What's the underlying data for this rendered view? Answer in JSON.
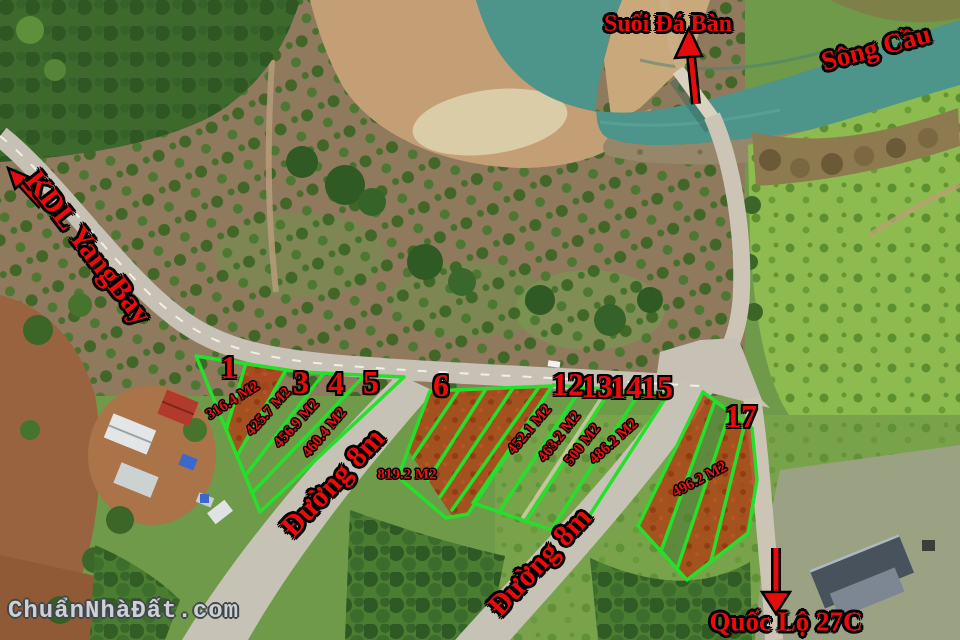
{
  "labels": {
    "stream": "Suối Đá Bàn",
    "river": "Sông Cầu",
    "kdl": "KDL YangBay",
    "road_a": "Đường 8m",
    "road_b": "Đường 8m",
    "highway": "Quốc Lộ 27C"
  },
  "watermark": "ChuẩnNhàĐất.com",
  "plots": [
    {
      "number": "1",
      "area": "316.4 M2"
    },
    {
      "number": "3",
      "area": "425.7 M2"
    },
    {
      "number": "4",
      "area": "456.9 M2"
    },
    {
      "number": "5",
      "area": "460.4 M2"
    },
    {
      "number": "6",
      "area": "819.2 M2"
    },
    {
      "number": "12",
      "area": "452.1 M2"
    },
    {
      "number": "13",
      "area": "463.2 M2"
    },
    {
      "number": "14",
      "area": "500 M2"
    },
    {
      "number": "15",
      "area": "486.2 M2"
    },
    {
      "number": "17",
      "area": "496.2 M2"
    }
  ],
  "colors": {
    "label_red": "#ea0c0c",
    "plot_outline_green": "#25e02b",
    "sold_fill_red": "#b23c12",
    "water_teal": "#4d948b",
    "road_gray": "#c6c2b6",
    "sand_tan": "#c49e74"
  }
}
